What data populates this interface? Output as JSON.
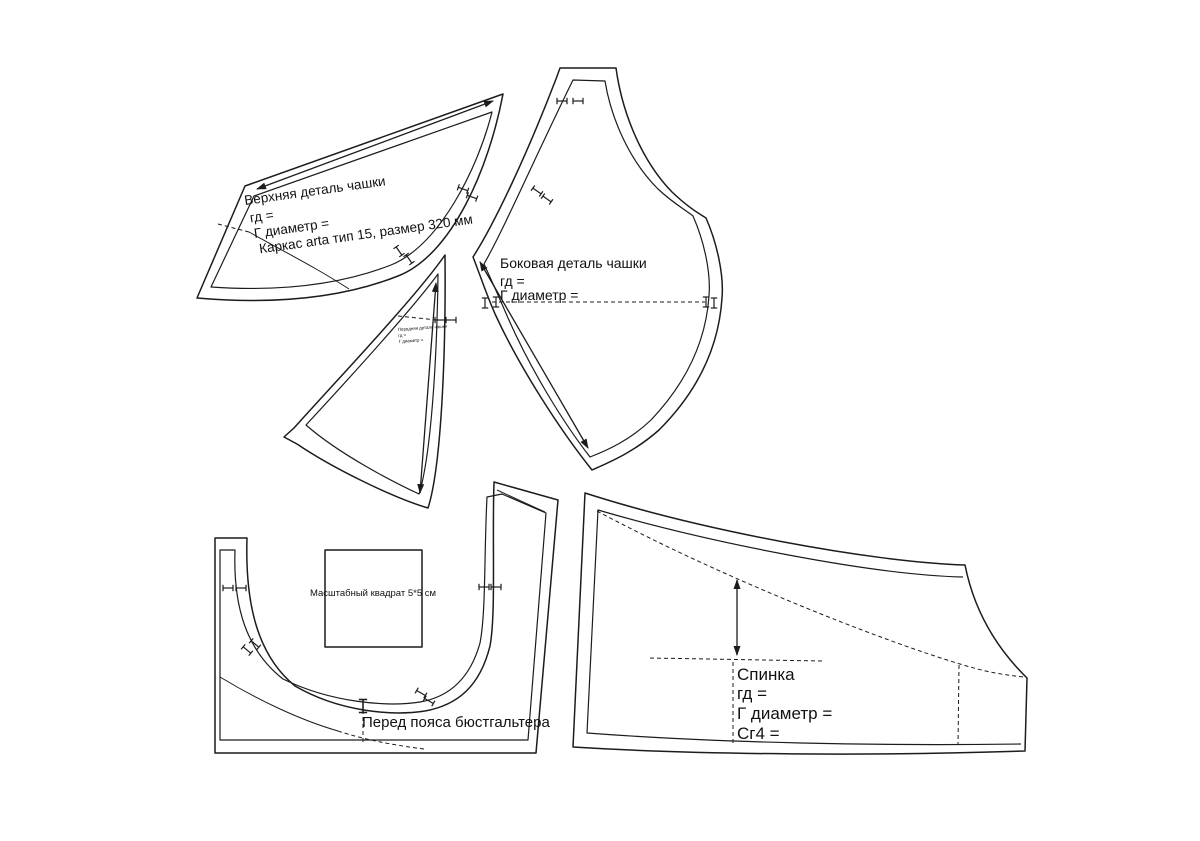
{
  "colors": {
    "line": "#1c1c1c",
    "background": "#ffffff"
  },
  "pieces": {
    "upper_cup": {
      "name": "Верхняя деталь чашки",
      "gd": "гд =",
      "diameter": "Г диаметр =",
      "wire": "Каркас arta тип 15, размер 320 мм"
    },
    "side_cup": {
      "name": "Боковая деталь чашки",
      "gd": "гд =",
      "diameter": "Г диаметр ="
    },
    "front_cup": {
      "name": "Передняя деталь чашки",
      "gd": "гд =",
      "diameter": "Г диаметр ="
    },
    "front_band": {
      "name": "Перед пояса бюстгальтера"
    },
    "back": {
      "name": "Спинка",
      "gd": "гд =",
      "diameter": "Г диаметр =",
      "sg4": "Сг4 ="
    },
    "scale_square": {
      "label": "Масштабный квадрат 5*5 см"
    }
  }
}
